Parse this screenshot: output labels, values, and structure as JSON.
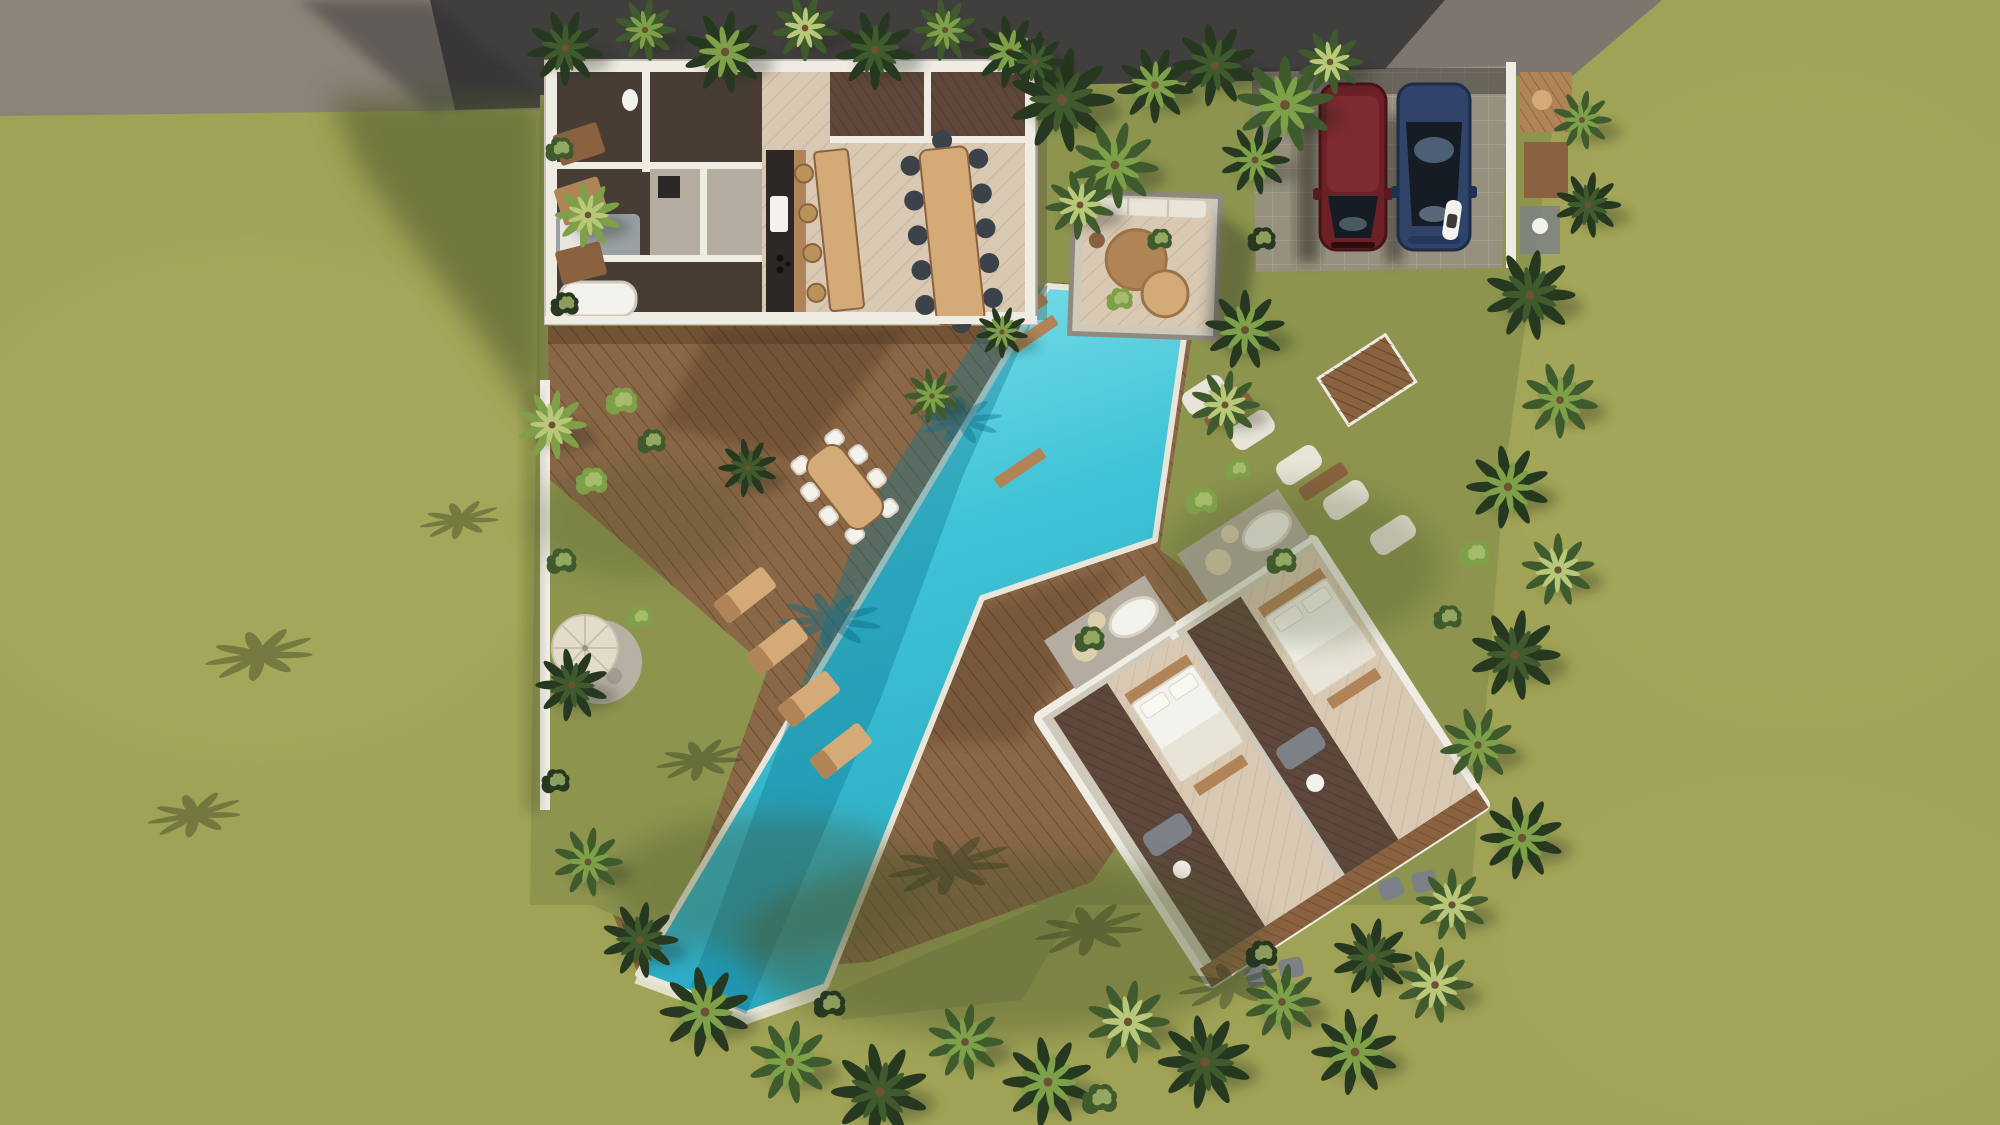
{
  "meta": {
    "type": "architectural-aerial-render",
    "subject": "Top-down 3D visualization of a tropical villa compound with L-shaped pool, wooden decks, parking and bedroom wing"
  },
  "palette": {
    "lawn": "#a0a356",
    "lawnLight": "#b0b264",
    "lawnInner": "#8d944e",
    "lawnShadow": "#4b5429",
    "roadLight": "#8c8378",
    "roadMid": "#6e6963",
    "roadDark": "#2e2d30",
    "paver": "#97907e",
    "paverLine": "#b2aa99",
    "wallWhite": "#efece4",
    "wallGray": "#c6c2b8",
    "deck": "#8a6746",
    "deckShadow": "#3a2513",
    "plankLine": "#5e4229",
    "pool": "#3fc3d6",
    "poolLight": "#8ce7ee",
    "poolDeep": "#1e9ab6",
    "poolShadow": "#0d7590",
    "poolRim": "#e9e5d8",
    "parquet": "#d9c9b3",
    "parquetLine": "#b6a489",
    "darkRoom": "#473d35",
    "darkFloor": "#5c473a",
    "stone": "#b4ad9f",
    "stoneLight": "#cfc9bb",
    "stonePad": "#dbcfae",
    "woodLight": "#d4ab77",
    "woodMid": "#b18457",
    "woodDark": "#8a6240",
    "counterBlack": "#2b2826",
    "chairDark": "#3c424a",
    "stoolTan": "#bb9257",
    "white": "#f4f2ec",
    "offWhite": "#e8e4d8",
    "grayObj": "#7b8187",
    "graySofa": "#9aa0a4",
    "carRed": "#6d2026",
    "carRedDark": "#451318",
    "carBlue": "#2f4468",
    "glassDark": "#151c24",
    "glassLight": "#7c97b8",
    "leafDark": "#26381f",
    "leafMid": "#3f5a2c",
    "leafLight": "#7da049",
    "leafPale": "#b9c878",
    "trunk": "#6b5233",
    "shadow": "#1c2412",
    "gravel": "#b7b1a3",
    "parasol": "#e3dccb"
  },
  "scene": {
    "ground": [
      "grass lawn",
      "asphalt road",
      "paver parking pad"
    ],
    "pool": {
      "count": 1,
      "shape": "long diagonal L-shape",
      "color": "turquoise"
    },
    "vehicles": [
      {
        "type": "car",
        "color": "dark red"
      },
      {
        "type": "car",
        "color": "dark blue"
      },
      {
        "type": "scooter",
        "color": "white"
      }
    ],
    "buildings": {
      "main_villa": {
        "rooms": [
          "kitchen",
          "dining",
          "bathrooms",
          "bedroom"
        ],
        "kitchen_stools": 4,
        "dining_chairs": 12,
        "bathtubs": 1
      },
      "pool_pavilion": {
        "round_tables": 2,
        "bench_cushions": 3
      },
      "bedroom_wing": {
        "suites": 2,
        "beds": 2,
        "bathtubs": 2
      }
    },
    "outdoor": {
      "sun_loungers": 4,
      "outdoor_dining_chairs": 8,
      "parasol": 1,
      "gravel_circle": 1,
      "stepping_stones": 5,
      "slatted_roof_gate": 1
    },
    "vegetation": [
      "palm trees",
      "tropical bushes",
      "banana plants"
    ]
  }
}
